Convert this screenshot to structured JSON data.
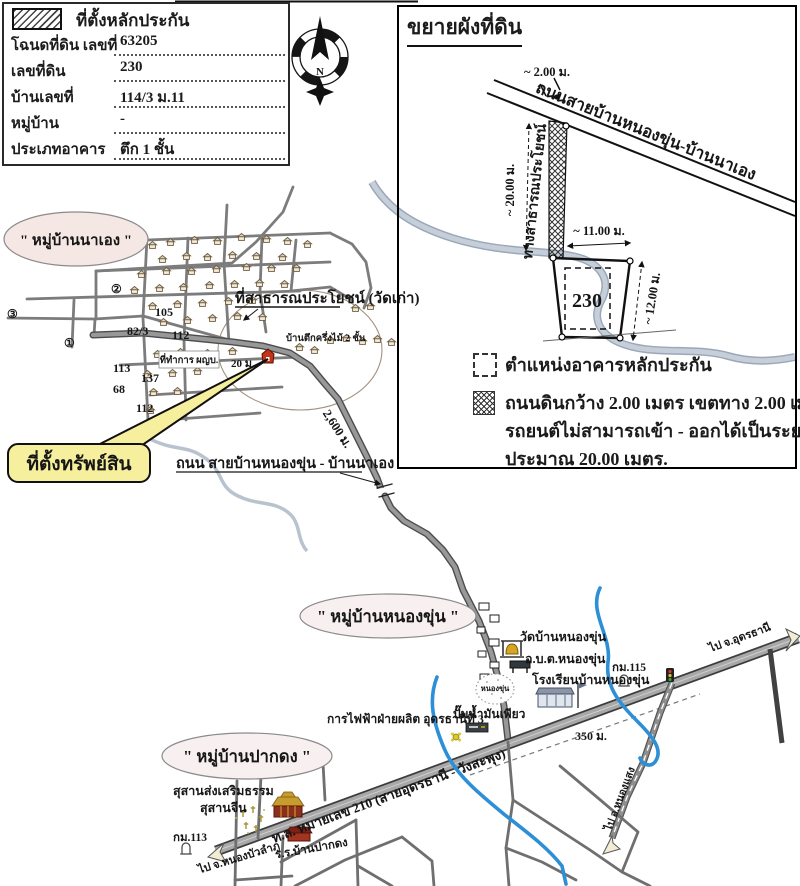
{
  "form": {
    "title": "ที่ตั้งหลักประกัน",
    "rows": [
      {
        "label": "โฉนดที่ดิน เลขที่",
        "value": "63205"
      },
      {
        "label": "เลขที่ดิน",
        "value": "230"
      },
      {
        "label": "บ้านเลขที่",
        "value": "114/3 ม.11"
      },
      {
        "label": "หมู่บ้าน",
        "value": "-"
      },
      {
        "label": "ประเภทอาคาร",
        "value": "ตึก 1 ชั้น"
      }
    ]
  },
  "compass": {
    "north": "N"
  },
  "inset": {
    "title": "ขยายผังที่ดิน",
    "road_label": "ถนนสายบ้านหนองขุ่น-บ้านนาเอง",
    "dim_top": "~ 2.00 ม.",
    "dim_left": "~ 20.00 ม.",
    "dim_width": "~ 11.00 ม.",
    "dim_right": "~ 12.00 ม.",
    "public_way": "ทางสาธารณประโยชน์",
    "plot_no": "230",
    "legend_building": "ตำแหน่งอาคารหลักประกัน",
    "legend_road_1": "ถนนดินกว้าง 2.00 เมตร เขตทาง 2.00 เมตร",
    "legend_road_2": "รถยนต์ไม่สามารถเข้า - ออกได้เป็นระยะทาง",
    "legend_road_3": "ประมาณ 20.00 เมตร."
  },
  "na_aeng": {
    "name": "\" หมู่บ้านนาเอง \"",
    "public_land": "ที่สาธารณประโยชน์ (วัดเก่า)",
    "headman": "ที่ทำการ ผญบ.",
    "house_note": "บ้านตึกครึ่งไม้ 2 ชั้น",
    "dist20": "20 ม.",
    "callout": "ที่ตั้งทรัพย์สิน",
    "road_label": "ถนน สายบ้านหนองขุ่น - บ้านนาเอง",
    "dist2600": "2,600 ม.",
    "n105": "105",
    "n82": "82/3",
    "n112a": "112",
    "n113": "113",
    "n137": "137",
    "n68": "68",
    "n112b": "112",
    "c1": "①",
    "c2": "②",
    "c3": "③"
  },
  "nong_khun": {
    "name": "\" หมู่บ้านหนองขุ่น \"",
    "temple": "วัดบ้านหนองขุ่น",
    "sao": "อ.บ.ต.หนองขุ่น",
    "school": "โรงเรียนบ้านหนองขุ่น",
    "pond": "หนองขุ่น",
    "km115": "กม.115",
    "egat": "การไฟฟ้าฝ่ายผลิต อุดรธานีที่ 3",
    "gas": "ปั๊มน้ำมันเพียว",
    "dist350": "350 ม.",
    "to_udon": "ไป จ.อุดรธานี",
    "to_nong_saeng": "ไป อ.หนองแสง",
    "highway": "ท.ล. หมายเลข 210 (สายอุดรธานี - วังสะพุง)"
  },
  "pak_dong": {
    "name": "\" หมู่บ้านปากดง \"",
    "cem1": "สุสานส่งเสริมธรรม",
    "cem2": "สุสานจีน",
    "km113": "กม.113",
    "to_nong_bua": "ไป จ.หนองบัวลำภู",
    "school": "ร.ร.บ้านปากดง"
  },
  "colors": {
    "callout_yellow": "#f6ef9d",
    "river_blue": "#2d8fd5",
    "bell_gold": "#d9a520",
    "marker_red": "#c23318"
  }
}
